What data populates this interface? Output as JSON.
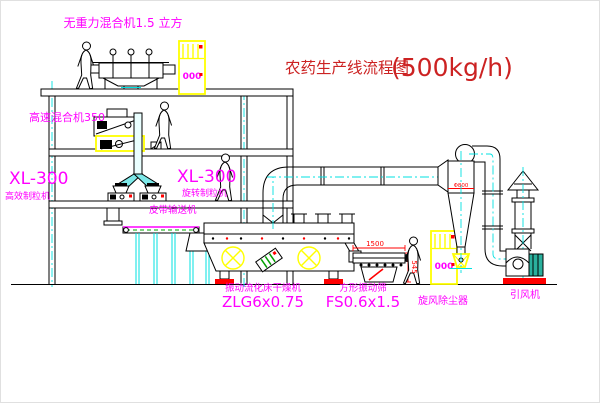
{
  "diagram": {
    "title": {
      "cn": "农药生产线流程图",
      "capacity": "(500kg/h)"
    },
    "labels": {
      "gravity_mixer": "无重力混合机1.5 立方",
      "high_speed_mixer": "高速混合机350",
      "granulator_left_model": "XL-300",
      "granulator_left_name": "高效制粒机",
      "granulator_right_model": "XL-300",
      "granulator_right_name": "旋转制粒机",
      "belt_conveyor": "皮带输送机",
      "dryer_name": "振动流化床干燥机",
      "dryer_model": "ZLG6x0.75",
      "sieve_name": "方形振动筛",
      "sieve_model": "FS0.6x1.5",
      "cyclone": "旋风除尘器",
      "fan": "引风机"
    },
    "dimensions": {
      "sieve_length": "1500",
      "sieve_height": "545",
      "cyclone_note": "Φ800"
    },
    "cabinet_display": "000",
    "colors": {
      "label_magenta": "#ff00ff",
      "title_red": "#cc2222",
      "dimension_red": "#ff0000",
      "equipment_yellow": "#ffff00",
      "centerline_cyan": "#00e0e0",
      "belt_green": "#00a000",
      "motor_teal": "#2ab09d",
      "line_black": "#000000",
      "background": "#ffffff"
    }
  }
}
